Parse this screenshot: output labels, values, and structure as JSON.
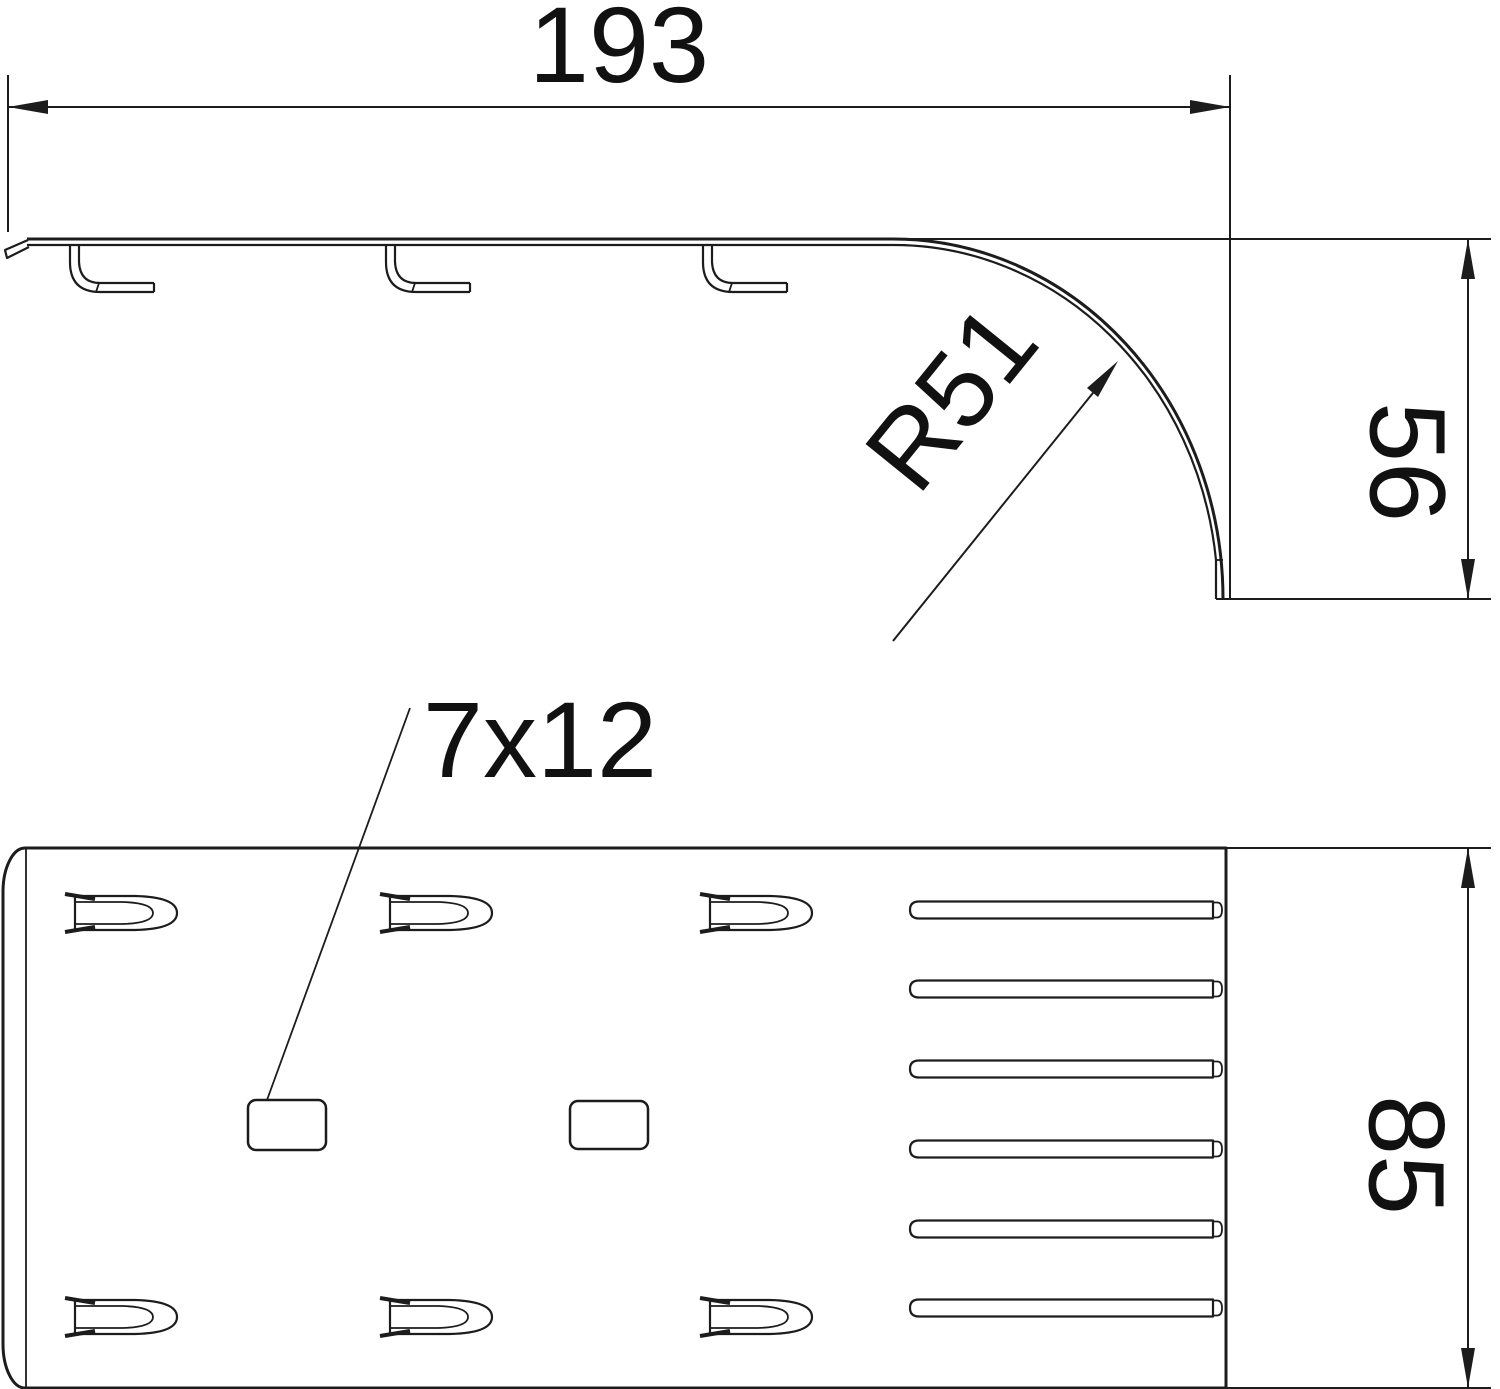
{
  "drawing": {
    "type": "technical-dimension-drawing",
    "views": {
      "side_view": "side elevation with bend radius",
      "plan_view": "plan view with slots and holes"
    },
    "dimensions": {
      "length": "193",
      "radius": "R51",
      "height": "56",
      "hole": "7x12",
      "width": "85"
    },
    "colors": {
      "line": "#1c1c1c",
      "background": "#ffffff"
    }
  }
}
